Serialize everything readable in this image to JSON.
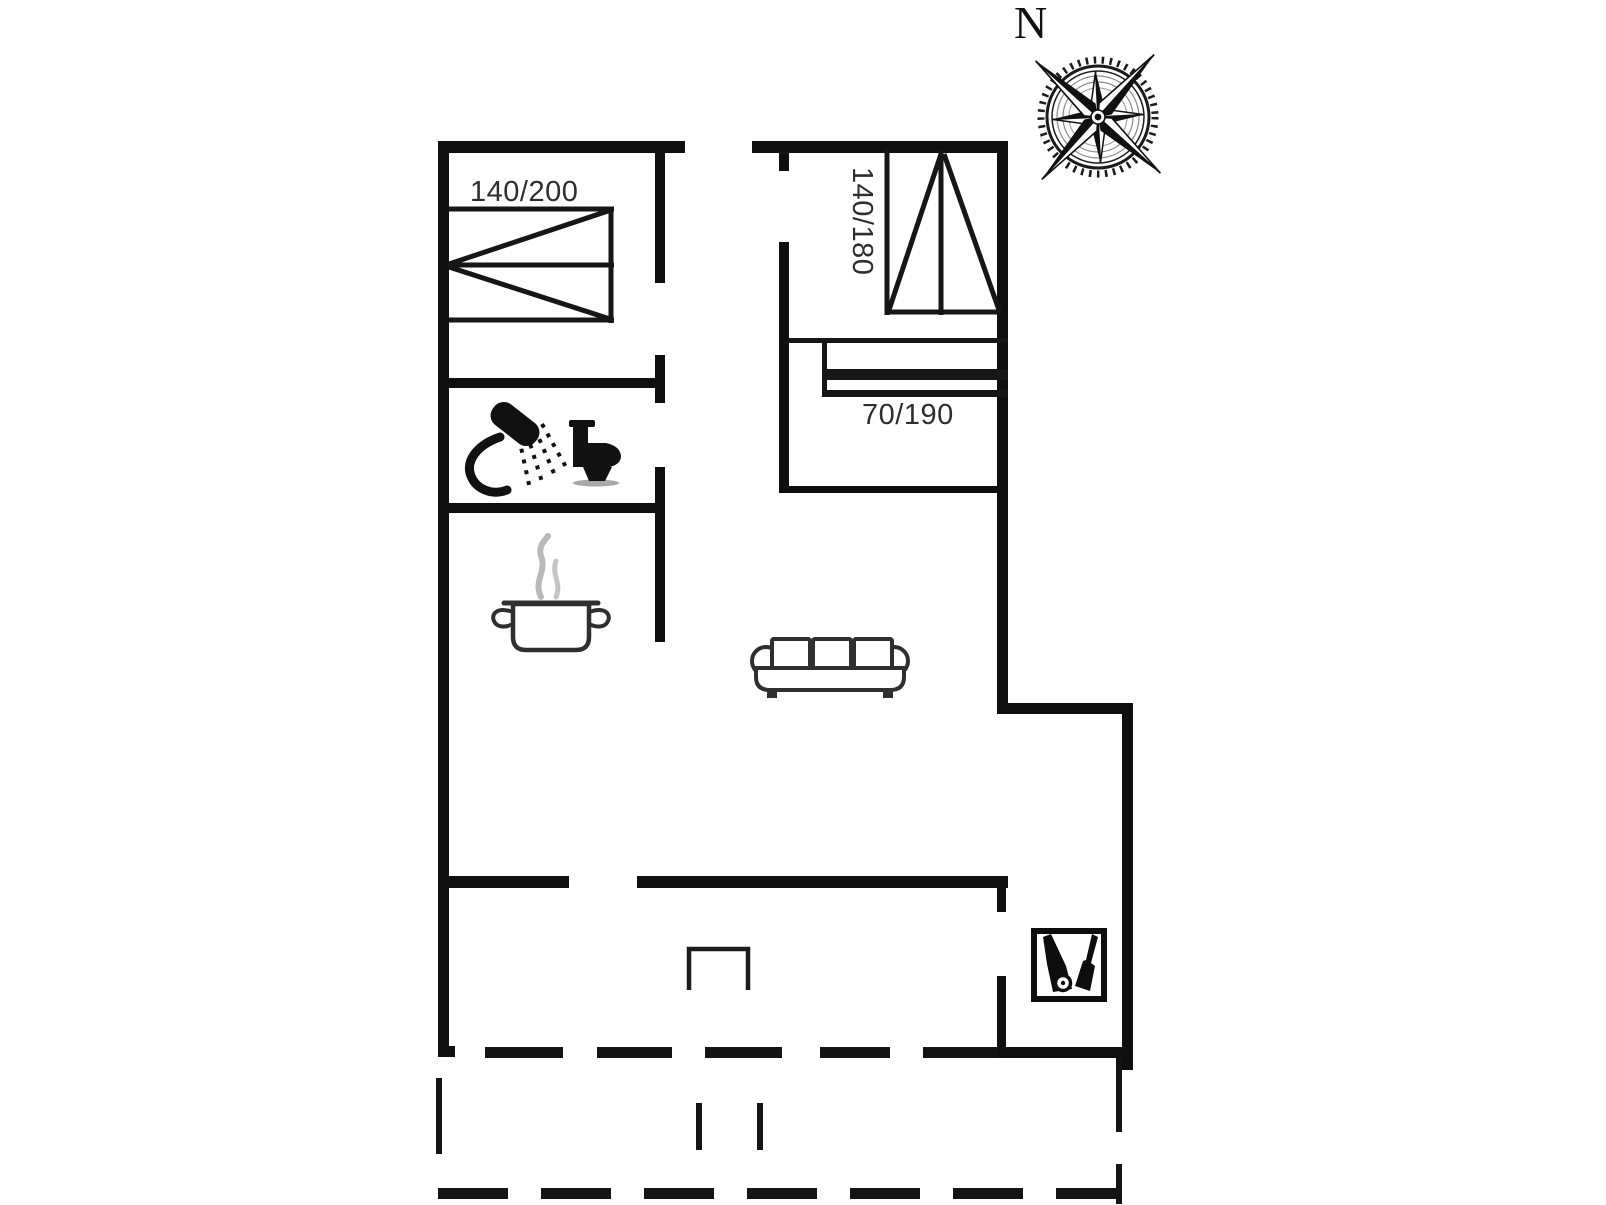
{
  "page": {
    "background": "#ffffff"
  },
  "plan": {
    "type": "holiday-house-floor-plan",
    "colors": {
      "wall": "#0f0f0f",
      "icon_outline": "#2f2f2f",
      "label": "#2e2e2e",
      "steam": "#b9b9b9"
    },
    "labels": {
      "bed_140_200": "140/200",
      "bed_140_180": "140/180",
      "bunk_70_190": "70/190",
      "north": "N"
    },
    "icons": {
      "compass": "compass-rose-icon",
      "double_bed_horizontal": "double-bed-icon",
      "double_bed_vertical": "double-bed-vertical-icon",
      "bunk_bed": "bunk-bed-icon",
      "shower": "shower-icon",
      "toilet": "toilet-icon",
      "cooking_pot": "cooking-pot-icon",
      "sofa": "sofa-icon",
      "vacuum_cleaner": "vacuum-cleaner-icon",
      "chimney": "chimney-icon",
      "terrace": "terrace-dashed-outline"
    }
  }
}
